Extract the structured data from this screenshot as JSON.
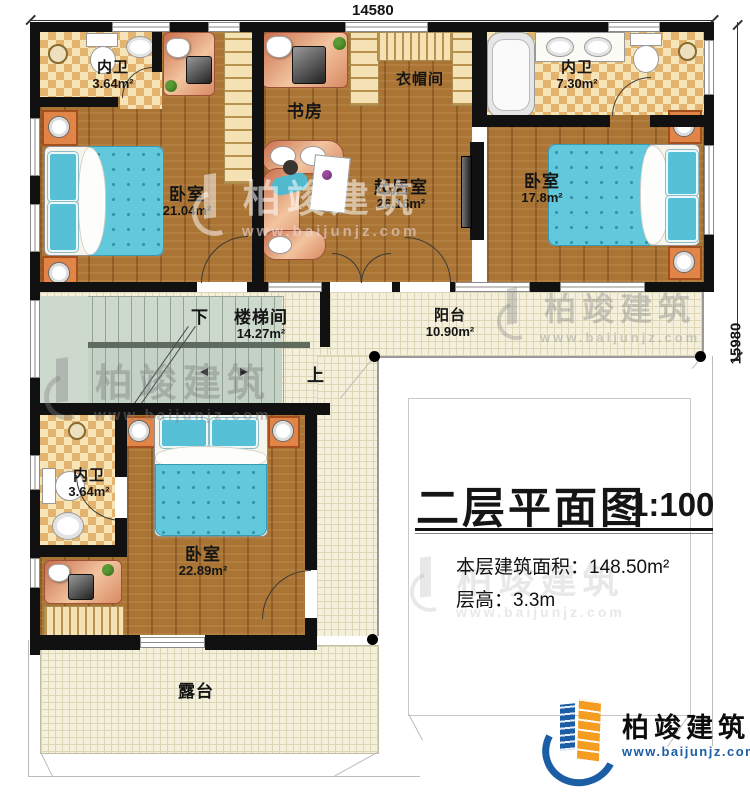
{
  "dimensions": {
    "top_width": "14580",
    "right_height": "15980"
  },
  "rooms": {
    "bath_top_left": {
      "name": "内卫",
      "area": "3.64m²"
    },
    "bedroom_top_left": {
      "name": "卧室",
      "area": "21.04m²"
    },
    "study": {
      "name": "书房"
    },
    "cloakroom": {
      "name": "衣帽间"
    },
    "living_room": {
      "name": "起居室",
      "area": "26.16m²"
    },
    "bath_top_right": {
      "name": "内卫",
      "area": "7.30m²"
    },
    "bedroom_right": {
      "name": "卧室",
      "area": "17.8m²"
    },
    "stairwell": {
      "name": "楼梯间",
      "area": "14.27m²",
      "down_label": "下",
      "up_label": "上"
    },
    "balcony": {
      "name": "阳台",
      "area": "10.90m²"
    },
    "bath_lower": {
      "name": "内卫",
      "area": "3.64m²"
    },
    "bedroom_lower": {
      "name": "卧室",
      "area": "22.89m²"
    },
    "terrace": {
      "name": "露台"
    }
  },
  "title_block": {
    "title": "二层平面图",
    "scale": "1:100",
    "floor_area_label": "本层建筑面积：",
    "floor_area_value": "148.50m²",
    "floor_height_label": "层高：",
    "floor_height_value": "3.3m"
  },
  "brand": {
    "name": "柏竣建筑",
    "website": "www.baijunjz.com"
  },
  "colors": {
    "wall": "#111111",
    "wood": "#a97434",
    "tile": "#e9c27c",
    "bed": "#5ec7dc",
    "stair": "#ccd8cb",
    "paving": "#f3efda",
    "brand_blue": "#1b5ea6",
    "brand_orange": "#f59d20"
  }
}
